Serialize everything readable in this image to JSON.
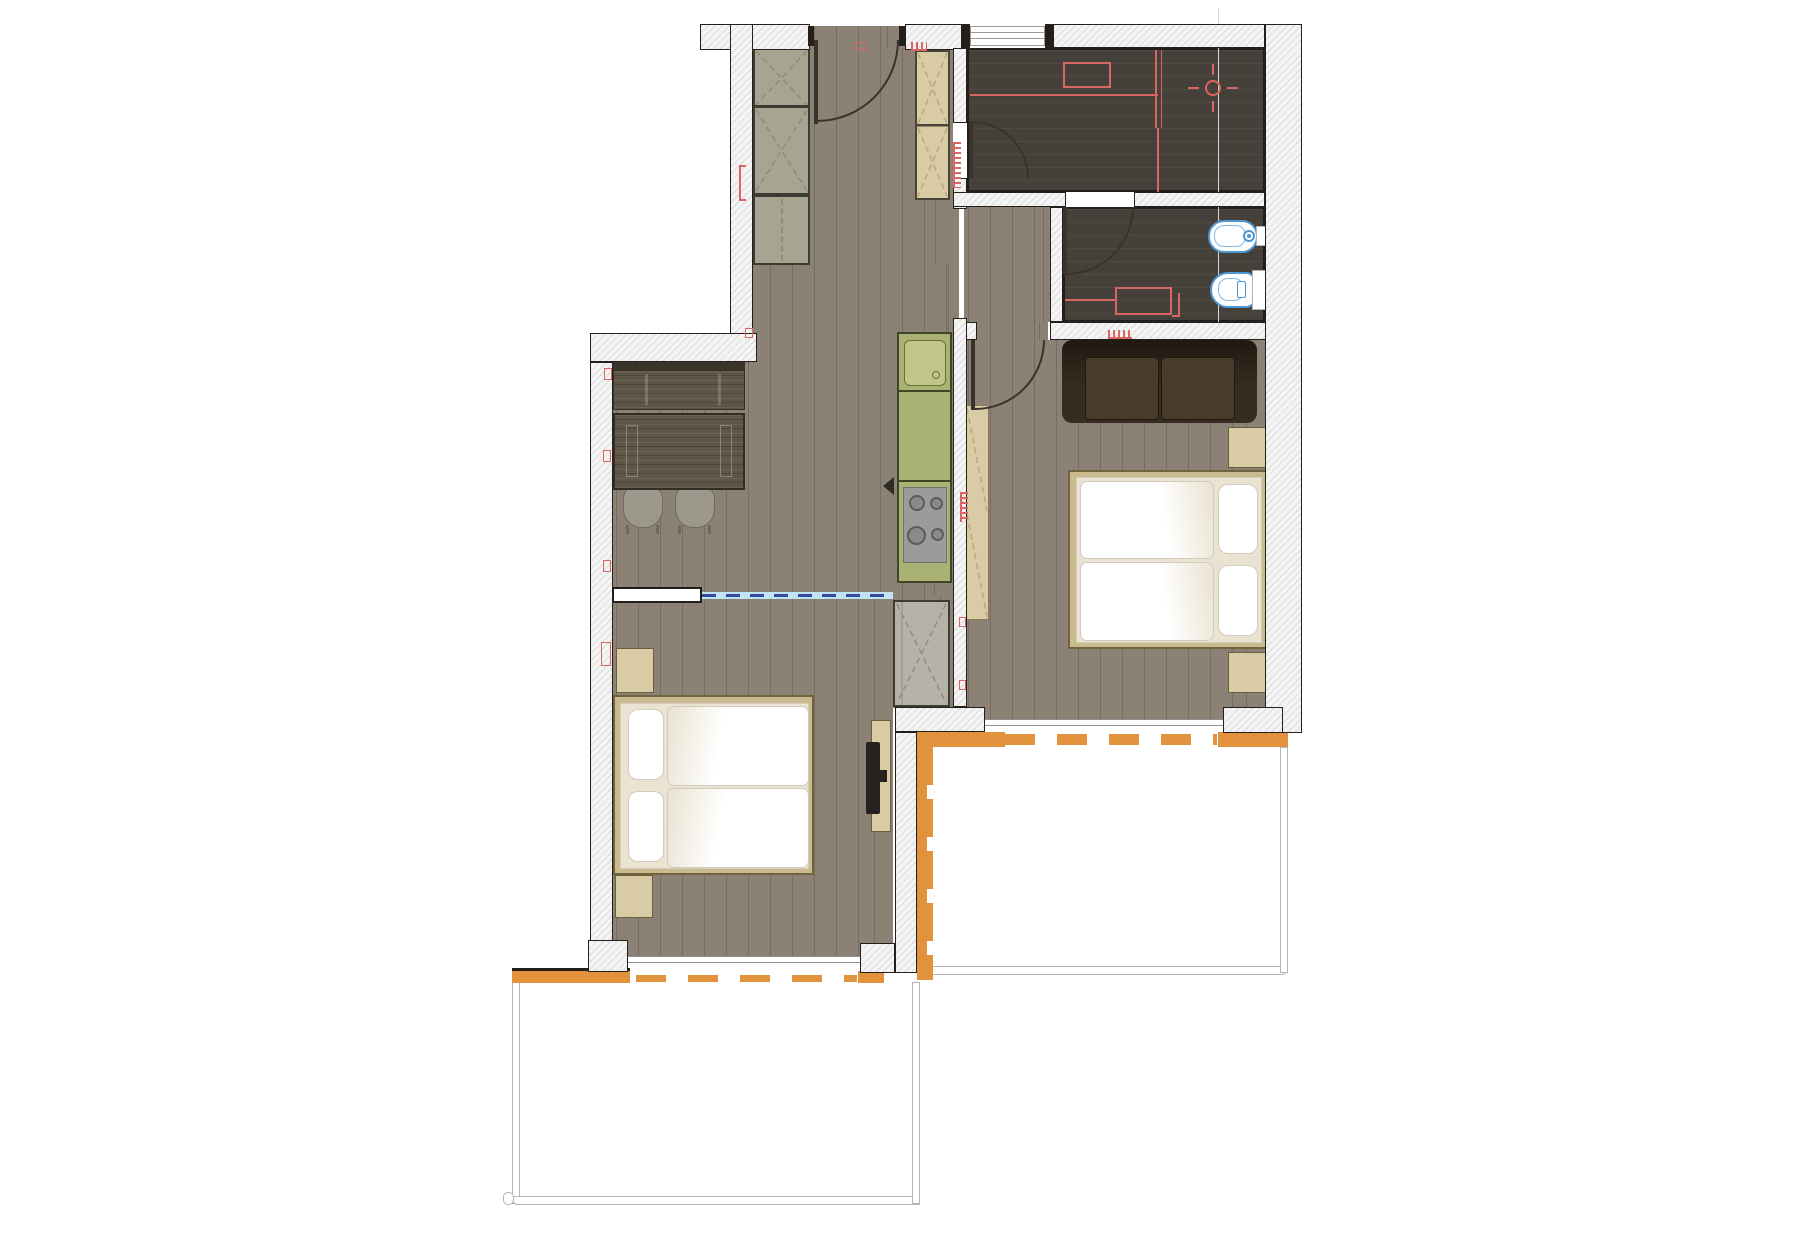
{
  "title": "Apartment floor plan — two bedrooms, shower room, WC, kitchen-living area and two balconies",
  "colors": {
    "floor_wood": "#8b8175",
    "floor_dark": "#46403a",
    "wall_fill": "#f4f4f4",
    "wall_line": "#241f1a",
    "kitchen_green": "#a9b173",
    "sink_green": "#c0c687",
    "furniture_tan": "#d9cba4",
    "cabinet_gray_green": "#a8a492",
    "cabinet_gray": "#b5b3a8",
    "wood_dark": "#5e5748",
    "sofa_brown": "#362c21",
    "bed_frame": "#c9ba90",
    "mattress": "#eae3d2",
    "bedding": "#ffffff",
    "threshold_orange": "#e2923c",
    "partition_blue": "#bfe4f4",
    "partition_dash": "#3d47a0",
    "annotation_red": "#d96662",
    "fixture_blue": "#4f97d0",
    "rail_gray": "#b5b5b5"
  },
  "rooms": [
    {
      "id": "entrance-hall",
      "floor": "wood-plank"
    },
    {
      "id": "shower-laundry-room",
      "floor": "dark-tile"
    },
    {
      "id": "wc",
      "floor": "dark-tile"
    },
    {
      "id": "corridor",
      "floor": "wood-plank"
    },
    {
      "id": "kitchen-living-dining",
      "floor": "wood-plank"
    },
    {
      "id": "bedroom-left",
      "floor": "wood-plank"
    },
    {
      "id": "bedroom-right",
      "floor": "wood-plank"
    },
    {
      "id": "balcony-left",
      "floor": "white"
    },
    {
      "id": "balcony-right",
      "floor": "white"
    }
  ],
  "furniture": [
    "entry-wardrobe",
    "hall-low-cabinet",
    "tall-cabinet",
    "kitchen-counter-sink-hob",
    "dining-bench",
    "dining-table",
    "dining-chair-left",
    "dining-chair-right",
    "storage-cabinet",
    "angled-wardrobe",
    "sofa",
    "double-bed-left",
    "double-bed-right",
    "nightstand-x4",
    "sideboard-with-tv"
  ],
  "fixtures": [
    "bidet",
    "toilet",
    "sink",
    "hob-4-burners"
  ],
  "doors": [
    "entry-door",
    "shower-room-door",
    "wc-door",
    "bedroom-right-door"
  ],
  "windows": [
    "top-window"
  ],
  "annotations": [
    "red-electrical-overlay",
    "ceiling-lamp-symbol",
    "red-radiator",
    "heating-combs",
    "blue-sliding-partition",
    "grid-line"
  ]
}
